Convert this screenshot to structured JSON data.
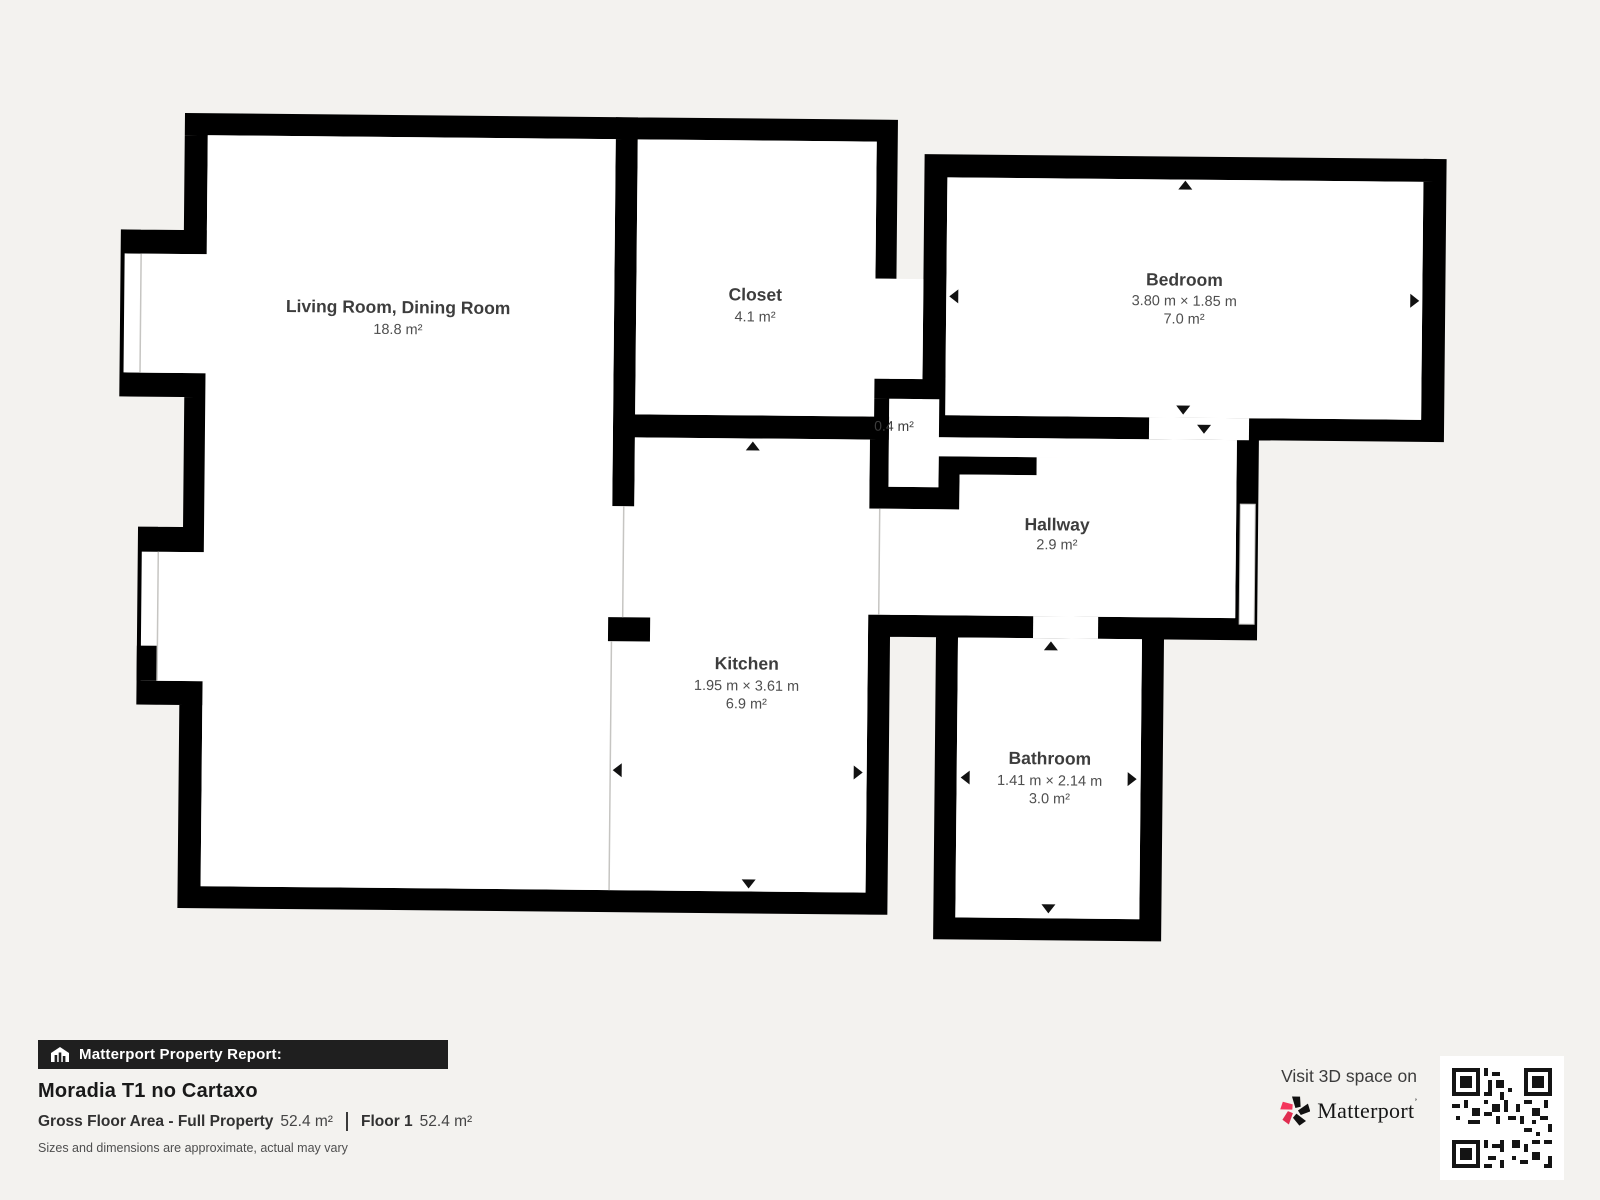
{
  "floorplan": {
    "rooms": [
      {
        "id": "living",
        "name": "Living Room, Dining Room",
        "dims": "",
        "area": "18.8 m²"
      },
      {
        "id": "closet",
        "name": "Closet",
        "dims": "",
        "area": "4.1 m²"
      },
      {
        "id": "bedroom",
        "name": "Bedroom",
        "dims": "3.80 m × 1.85 m",
        "area": "7.0 m²"
      },
      {
        "id": "niche",
        "name": "",
        "dims": "",
        "area": "0.4 m²"
      },
      {
        "id": "hallway",
        "name": "Hallway",
        "dims": "",
        "area": "2.9 m²"
      },
      {
        "id": "kitchen",
        "name": "Kitchen",
        "dims": "1.95 m × 3.61 m",
        "area": "6.9 m²"
      },
      {
        "id": "bathroom",
        "name": "Bathroom",
        "dims": "1.41 m × 2.14 m",
        "area": "3.0 m²"
      }
    ]
  },
  "footer": {
    "report_label": "Matterport Property Report:",
    "property_title": "Moradia T1 no Cartaxo",
    "gross_label": "Gross Floor Area - Full Property",
    "gross_value": "52.4 m²",
    "floor_label": "Floor 1",
    "floor_value": "52.4 m²",
    "disclaimer": "Sizes and dimensions are approximate, actual may vary"
  },
  "cta": {
    "visit_text": "Visit 3D space on",
    "brand": "Matterport"
  },
  "icons": [
    "matterport-house-icon",
    "matterport-logo-icon",
    "qr-code"
  ],
  "colors": {
    "background": "#f3f2ef",
    "wall": "#000000",
    "room_fill": "#ffffff",
    "label_text": "#3d3d3d",
    "brand_pink": "#f4365c",
    "report_bar_bg": "#1f1f1f"
  }
}
